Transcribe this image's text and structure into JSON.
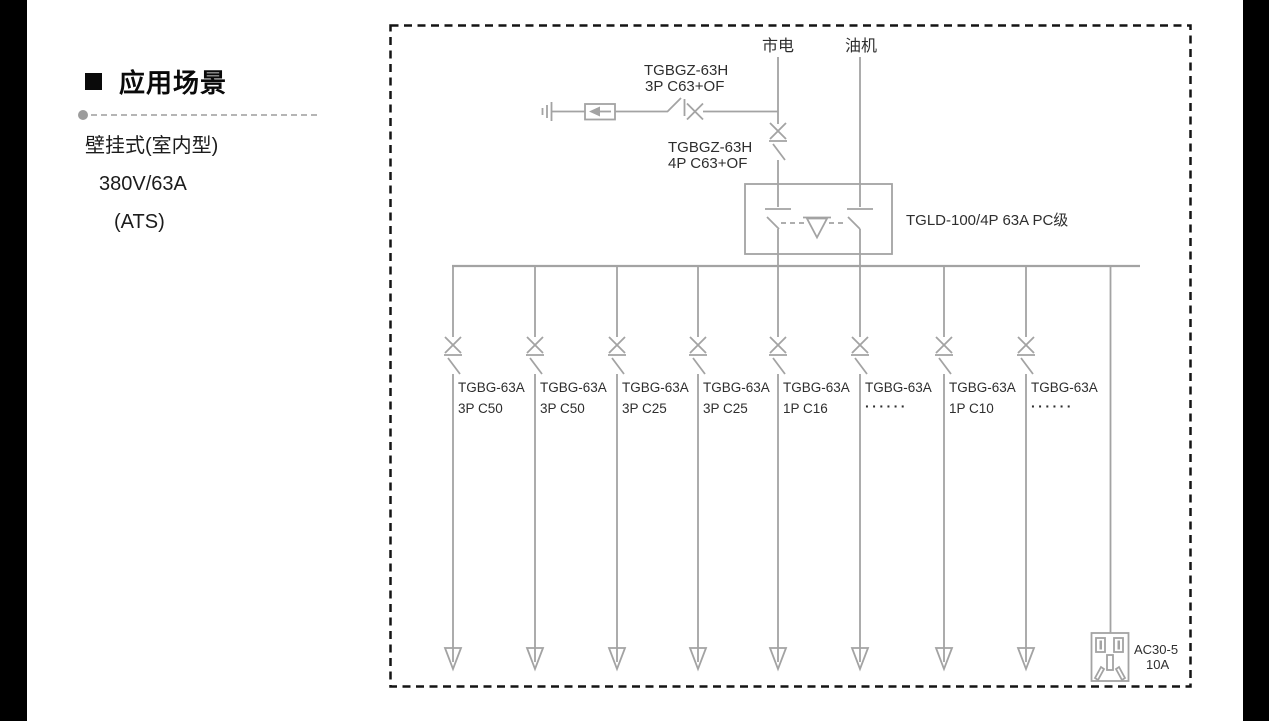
{
  "left_panel": {
    "heading": "应用场景",
    "specs": [
      "壁挂式(室内型)",
      "380V/63A",
      "(ATS)"
    ]
  },
  "diagram": {
    "mains_label": "市电",
    "generator_label": "油机",
    "spd_breaker": {
      "line1": "TGBGZ-63H",
      "line2": "3P C63+OF"
    },
    "incoming_breaker": {
      "line1": "TGBGZ-63H",
      "line2": "4P C63+OF"
    },
    "ats_label": "TGLD-100/4P 63A PC级",
    "branches": [
      {
        "model": "TGBG-63A",
        "spec": "3P C50"
      },
      {
        "model": "TGBG-63A",
        "spec": "3P C50"
      },
      {
        "model": "TGBG-63A",
        "spec": "3P C25"
      },
      {
        "model": "TGBG-63A",
        "spec": "3P C25"
      },
      {
        "model": "TGBG-63A",
        "spec": "1P C16"
      },
      {
        "model": "TGBG-63A",
        "spec": "······"
      },
      {
        "model": "TGBG-63A",
        "spec": "1P C10"
      },
      {
        "model": "TGBG-63A",
        "spec": "······"
      }
    ],
    "socket": {
      "line1": "AC30-5",
      "line2": "10A"
    },
    "colors": {
      "line": "#a3a3a3",
      "text": "#2e2e2e",
      "border": "#141414"
    }
  }
}
